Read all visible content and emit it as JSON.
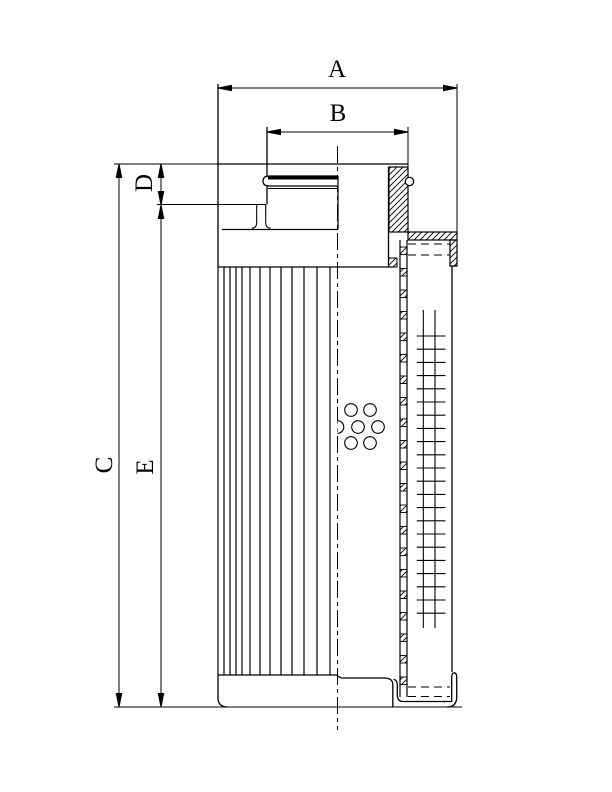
{
  "page": {
    "background": "#ffffff",
    "ink": "#000000"
  },
  "drawing": {
    "type": "filter-element-cross-section",
    "labels": {
      "A": "A",
      "B": "B",
      "C": "C",
      "D": "D",
      "E": "E"
    }
  },
  "figure": {
    "pleats": {
      "xs": [
        218,
        224,
        230,
        236,
        242,
        250,
        260,
        270,
        281,
        292,
        304,
        317,
        330
      ],
      "y1": 267,
      "y2": 675
    },
    "holes": {
      "r": 6.3,
      "centers": [
        [
          351,
          410
        ],
        [
          370,
          410
        ],
        [
          358,
          427
        ],
        [
          378,
          427
        ],
        [
          351,
          443
        ],
        [
          370,
          443
        ]
      ],
      "half": {
        "cx": 337.5,
        "cy": 427
      }
    },
    "mesh": {
      "rails_x": [
        423.3,
        435
      ],
      "rail_y1": 310,
      "rail_y2": 628,
      "tick_x1": 416.7,
      "tick_x2": 445.5,
      "tick_y0": 336,
      "tick_step": 13.2,
      "tick_count": 22
    },
    "wall_squares": {
      "x": 400,
      "w": 7,
      "y0": 247,
      "h": 7.5,
      "step": 21.5,
      "count": 21
    }
  }
}
